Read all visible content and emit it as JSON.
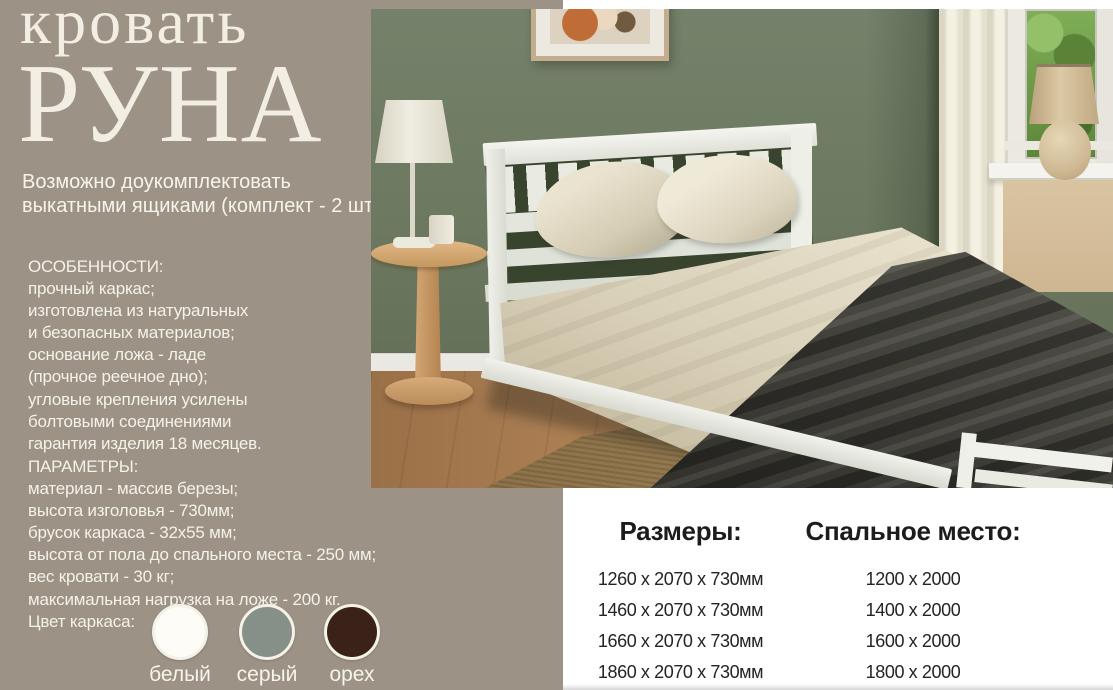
{
  "left_panel": {
    "title_line1": "кровать",
    "title_line2": "РУНА",
    "subtitle_line1": "Возможно доукомплектовать",
    "subtitle_line2": "выкатными ящиками (комплект - 2 шт)",
    "features": {
      "heading": "ОСОБЕННОСТИ:",
      "lines": [
        "прочный каркас;",
        "изготовлена из натуральных",
        "и безопасных материалов;",
        "основание ложа - ладе",
        "(прочное реечное дно);",
        "угловые крепления усилены",
        "болтовыми соединениями",
        "гарантия изделия 18 месяцев."
      ]
    },
    "parameters": {
      "heading": "ПАРАМЕТРЫ:",
      "lines": [
        "материал - массив березы;",
        "высота изголовья - 730мм;",
        "брусок каркаса - 32х55 мм;",
        "высота от пола до спального места - 250 мм;",
        "вес кровати - 30 кг;",
        "максимальная нагрузка на ложе - 200 кг."
      ]
    },
    "colors": {
      "label": "Цвет каркаса:",
      "options": [
        {
          "name": "белый",
          "hex": "#fdfcf6"
        },
        {
          "name": "серый",
          "hex": "#879088"
        },
        {
          "name": "орех",
          "hex": "#3b2218"
        }
      ]
    },
    "panel_color": "#9c9285"
  },
  "size_table": {
    "columns": [
      {
        "header": "Размеры:",
        "rows": [
          "1260 х 2070 х 730мм",
          "1460 х 2070 х 730мм",
          "1660 х 2070 х 730мм",
          "1860 х 2070 х 730мм"
        ]
      },
      {
        "header": "Спальное место:",
        "rows": [
          "1200 х 2000",
          "1400 х 2000",
          "1600 х 2000",
          "1800 х 2000"
        ]
      }
    ]
  }
}
